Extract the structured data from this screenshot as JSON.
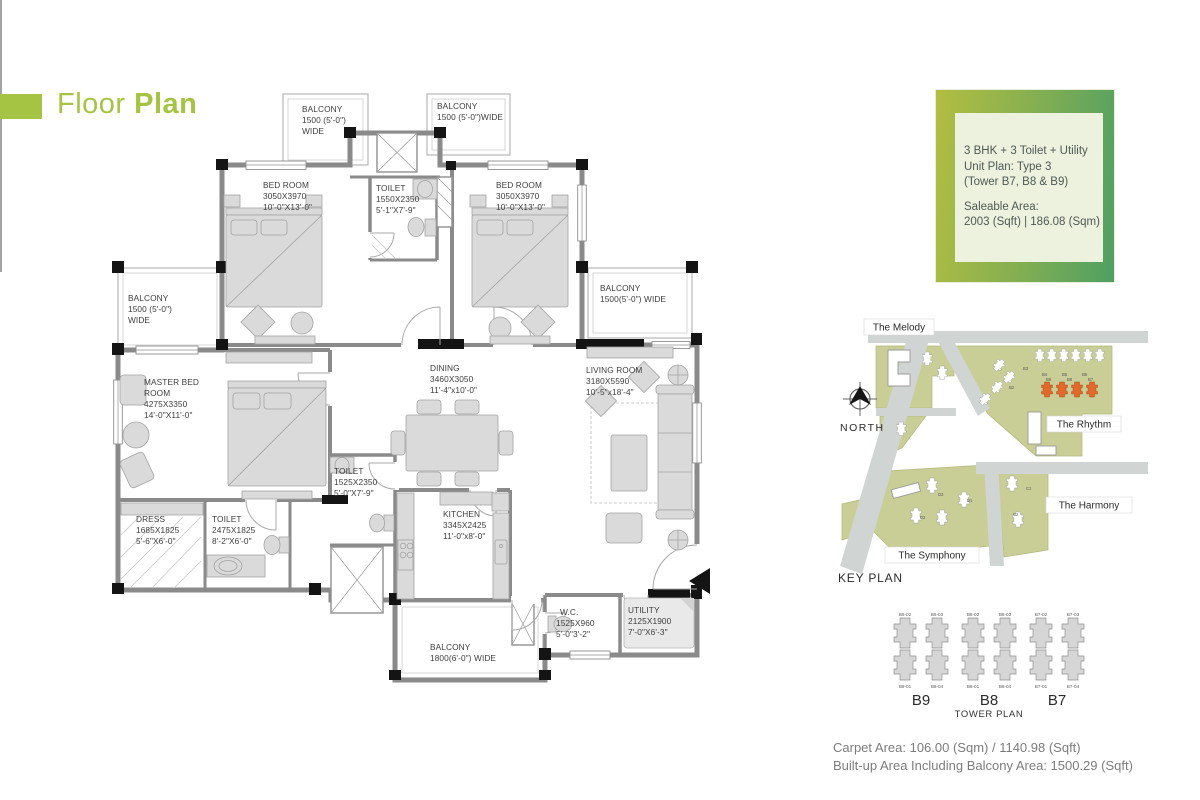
{
  "header": {
    "title_light": "Floor",
    "title_bold": "Plan"
  },
  "info_badge": {
    "unit_lines": [
      "3 BHK + 3 Toilet + Utility",
      "Unit Plan: Type 3",
      "(Tower B7, B8 & B9)"
    ],
    "saleable_lines": [
      "Saleable Area:",
      "2003 (Sqft) | 186.08 (Sqm)"
    ]
  },
  "floor_plan": {
    "rooms": [
      {
        "id": "balcony-top-left",
        "lines": [
          "BALCONY",
          "1500 (5'-0\")",
          "WIDE"
        ]
      },
      {
        "id": "balcony-top-right",
        "lines": [
          "BALCONY",
          "1500 (5'-0\")WIDE"
        ]
      },
      {
        "id": "bedroom-left",
        "lines": [
          "BED ROOM",
          "3050X3970",
          "10'-0\"X13'-0\""
        ]
      },
      {
        "id": "toilet-top",
        "lines": [
          "TOILET",
          "1550X2350",
          "5'-1\"X7'-9\""
        ]
      },
      {
        "id": "bedroom-right",
        "lines": [
          "BED ROOM",
          "3050X3970",
          "10'-0\"X13'-0\""
        ]
      },
      {
        "id": "balcony-mid-left",
        "lines": [
          "BALCONY",
          "1500 (5'-0\")",
          "WIDE"
        ]
      },
      {
        "id": "balcony-mid-right",
        "lines": [
          "BALCONY",
          "1500(5'-0\") WIDE"
        ]
      },
      {
        "id": "master-bedroom",
        "lines": [
          "MASTER BED",
          "ROOM",
          "4275X3350",
          "14'-0\"X11'-0\""
        ]
      },
      {
        "id": "dining",
        "lines": [
          "DINING",
          "3460X3050",
          "11'-4\"x10'-0\""
        ]
      },
      {
        "id": "living-room",
        "lines": [
          "LIVING ROOM",
          "3180X5590",
          "10'-5\"x18'-4\""
        ]
      },
      {
        "id": "toilet-mid",
        "lines": [
          "TOILET",
          "1525X2350",
          "5'-0\"X7'-9\""
        ]
      },
      {
        "id": "dress",
        "lines": [
          "DRESS",
          "1685X1825",
          "5'-6\"X6'-0\""
        ]
      },
      {
        "id": "toilet-master",
        "lines": [
          "TOILET",
          "2475X1825",
          "8'-2\"X6'-0\""
        ]
      },
      {
        "id": "kitchen",
        "lines": [
          "KITCHEN",
          "3345X2425",
          "11'-0\"x8'-0\""
        ]
      },
      {
        "id": "wc",
        "lines": [
          "W.C.",
          "1525X960",
          "5'-0\"3'-2\""
        ]
      },
      {
        "id": "utility",
        "lines": [
          "UTILITY",
          "2125X1900",
          "7'-0\"X6'-3\""
        ]
      },
      {
        "id": "balcony-bottom",
        "lines": [
          "BALCONY",
          "1800(6'-0\") WIDE"
        ]
      }
    ]
  },
  "key_plan": {
    "caption": "KEY PLAN",
    "north_label": "NORTH",
    "area_labels": [
      "The Melody",
      "The Rhythm",
      "The Harmony",
      "The Symphony"
    ],
    "tower_marks": [
      "B3",
      "B2",
      "B4",
      "B5",
      "B6",
      "B9",
      "B8",
      "B7",
      "D3",
      "D1",
      "D2",
      "C1",
      "C2"
    ],
    "highlight_color": "#e2692b"
  },
  "tower_plan": {
    "caption": "TOWER PLAN",
    "tower_labels": [
      "B9",
      "B8",
      "B7"
    ],
    "top_units": [
      "B9-02",
      "B9-03",
      "B8-02",
      "B8-03",
      "B7-02",
      "B7-03"
    ],
    "bottom_units": [
      "B9-01",
      "B9-04",
      "B8-01",
      "B8-04",
      "B7-01",
      "B7-04"
    ]
  },
  "footer": {
    "carpet_area": "Carpet Area: 106.00 (Sqm) / 1140.98 (Sqft)",
    "built_up_area": "Built-up Area Including Balcony Area: 1500.29 (Sqft)"
  },
  "colors": {
    "accent_green": "#a6c444",
    "badge_gradient_left": "#b2be41",
    "badge_gradient_right": "#4f9f63",
    "badge_inner_bg": "#edf2de",
    "keyplan_plot": "#c9ce97",
    "keyplan_road": "#d0d4d2",
    "highlight_orange": "#e2692b",
    "wall_gray": "#8a8a8a"
  }
}
